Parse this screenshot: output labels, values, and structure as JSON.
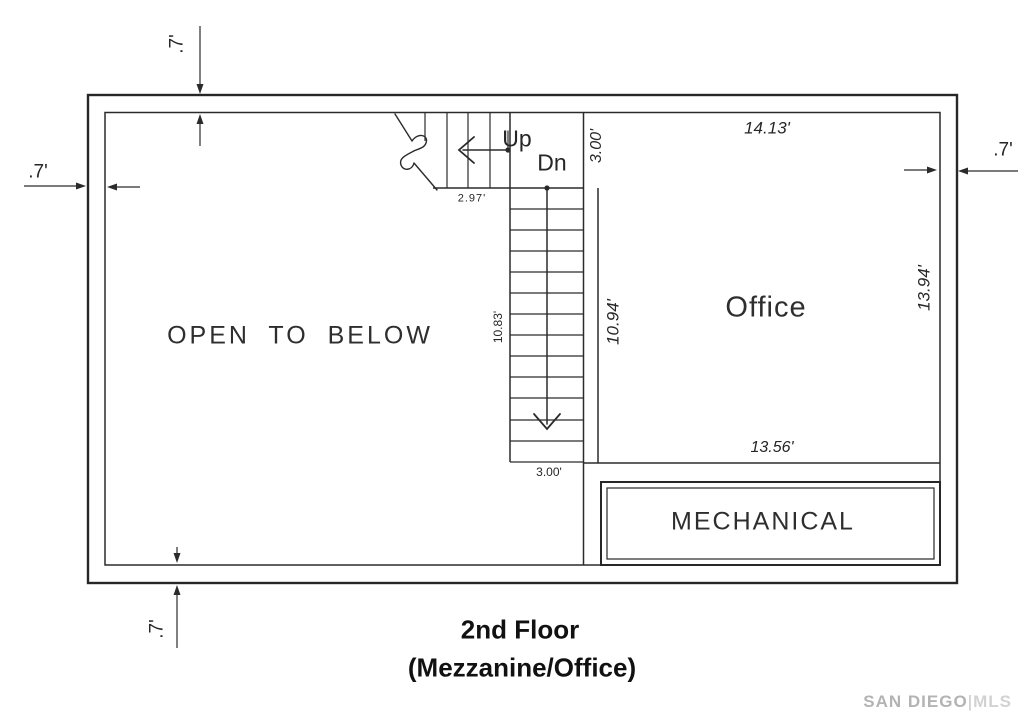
{
  "floor_plan": {
    "rooms": {
      "open_to_below": "OPEN TO BELOW",
      "office": "Office",
      "mechanical": "MECHANICAL"
    },
    "stairs": {
      "up": "Up",
      "down": "Dn"
    },
    "dimensions": {
      "wall_top": ".7'",
      "wall_left": ".7'",
      "wall_right": ".7'",
      "wall_bottom": ".7'",
      "stair_landing": "2.97'",
      "office_top": "14.13'",
      "stair_width_top": "3.00'",
      "stair_run_left": "10.83'",
      "stair_run_right": "10.94'",
      "office_right": "13.94'",
      "office_bottom": "13.56'",
      "stair_width_bottom": "3.00'"
    },
    "title": {
      "line1": "2nd Floor",
      "line2": "(Mezzanine/Office)"
    },
    "watermark": {
      "name": "SAN DIEGO",
      "divider": "|",
      "suffix": "MLS"
    }
  }
}
